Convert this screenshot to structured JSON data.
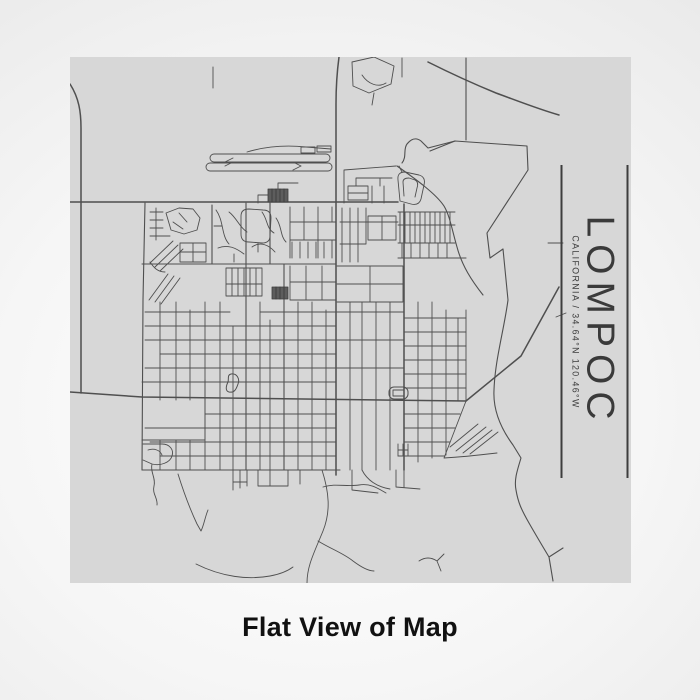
{
  "map_print": {
    "title": "LOMPOC",
    "subtitle": "CALIFORNIA / 34.64°N 120.46°W"
  },
  "caption": {
    "text": "Flat View of Map"
  },
  "colors": {
    "map_background": "#d7d7d7",
    "road_line": "#4f4f4f",
    "building_fill": "#5d5d5d",
    "frame_line": "#3d3d3d",
    "title_text": "#3a3a3a",
    "caption_text": "#111111",
    "page_background_center": "#ffffff",
    "page_background_edge": "#dedede"
  }
}
